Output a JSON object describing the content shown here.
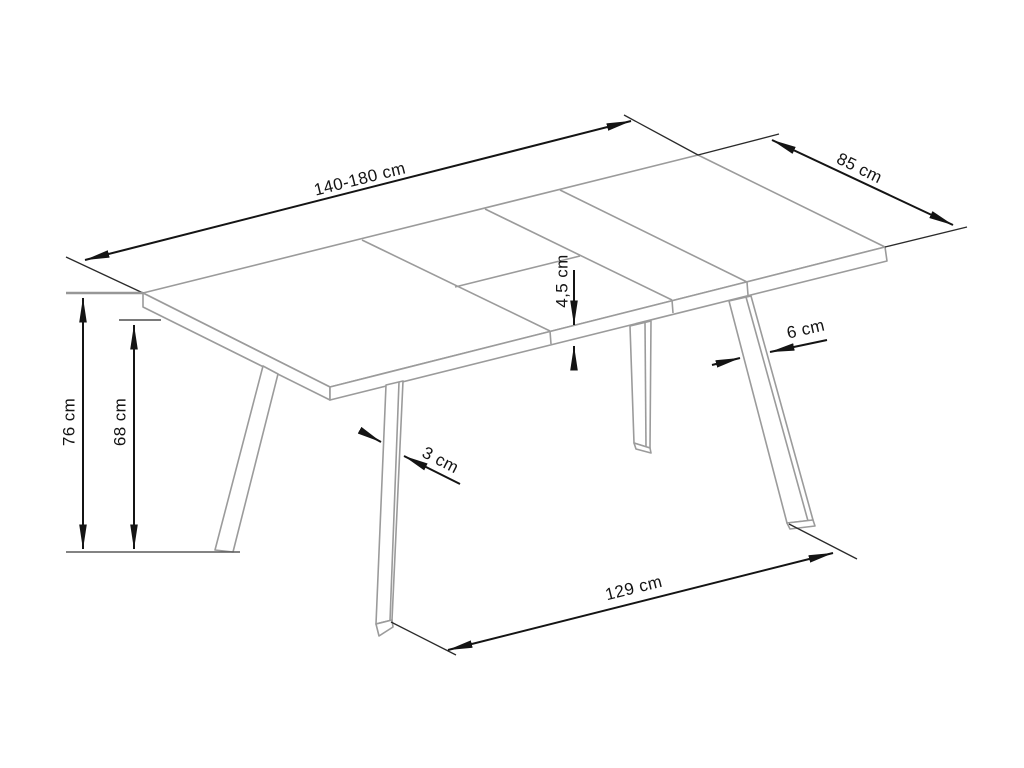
{
  "drawing": {
    "labels": {
      "length": "140-180 cm",
      "width": "85 cm",
      "height": "76 cm",
      "clearance": "68 cm",
      "top_thickness": "4,5 cm",
      "leg_width": "6 cm",
      "leg_thickness": "3 cm",
      "foot_span": "129 cm"
    },
    "colors": {
      "background": "#ffffff",
      "table_outline": "#9b9b9b",
      "dimension_ink": "#141414"
    }
  }
}
